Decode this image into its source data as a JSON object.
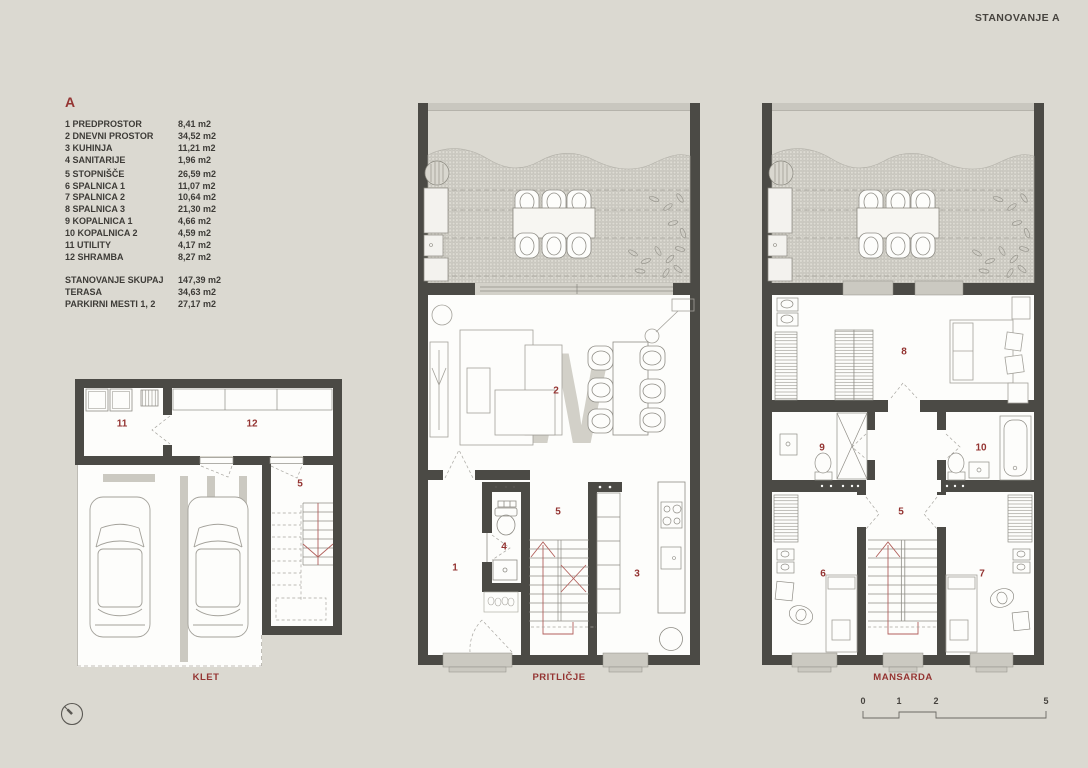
{
  "title": "STANOVANJE A",
  "watermark": "kW",
  "legend": {
    "header": "A",
    "rooms": [
      {
        "label": "1 PREDPROSTOR",
        "area": "8,41 m2"
      },
      {
        "label": "2 DNEVNI PROSTOR",
        "area": "34,52 m2"
      },
      {
        "label": "3 KUHINJA",
        "area": "11,21 m2"
      },
      {
        "label": "4 SANITARIJE",
        "area": "1,96 m2"
      },
      {
        "label": "5 STOPNIŠČE",
        "area": "26,59 m2"
      },
      {
        "label": "6 SPALNICA 1",
        "area": "11,07 m2"
      },
      {
        "label": "7 SPALNICA 2",
        "area": "10,64 m2"
      },
      {
        "label": "8 SPALNICA 3",
        "area": "21,30 m2"
      },
      {
        "label": "9 KOPALNICA 1",
        "area": "4,66 m2"
      },
      {
        "label": "10 KOPALNICA 2",
        "area": "4,59 m2"
      },
      {
        "label": "11 UTILITY",
        "area": "4,17 m2"
      },
      {
        "label": "12 SHRAMBA",
        "area": "8,27 m2"
      }
    ],
    "totals": [
      {
        "label": "STANOVANJE  SKUPAJ",
        "area": "147,39 m2"
      },
      {
        "label": "TERASA",
        "area": "34,63 m2"
      },
      {
        "label": "PARKIRNI MESTI 1, 2",
        "area": "27,17 m2"
      }
    ]
  },
  "plans": {
    "klet": {
      "caption": "KLET",
      "room_numbers": [
        "11",
        "12",
        "5"
      ]
    },
    "pritlicje": {
      "caption": "PRITLIČJE",
      "room_numbers": [
        "1",
        "2",
        "3",
        "4",
        "5"
      ]
    },
    "mansarda": {
      "caption": "MANSARDA",
      "room_numbers": [
        "8",
        "9",
        "10",
        "5",
        "6",
        "7"
      ]
    }
  },
  "scale_bar": {
    "ticks": [
      "0",
      "1",
      "2",
      "5"
    ]
  },
  "icons": {
    "north_arrow": "north-arrow-icon"
  },
  "colors": {
    "background": "#dbd9d1",
    "wall": "#4b4a45",
    "accent_red": "#943432",
    "text": "#3d3b37"
  }
}
